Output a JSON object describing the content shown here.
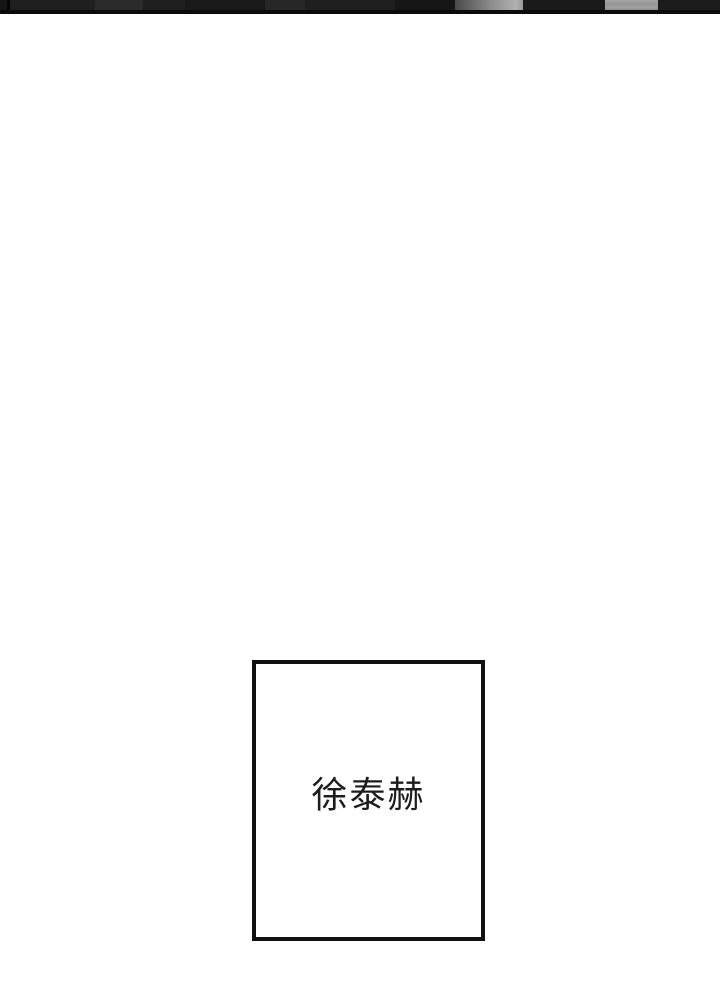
{
  "page": {
    "background_color": "#ffffff",
    "kind": "comic-page-segment"
  },
  "top_panel_edge": {
    "description": "bottom sliver of previous panel cut off by top of screenshot",
    "base_color": "#1f1f1f",
    "bottom_border_color": "#0b0b0b",
    "highlight_color": "#a0a0a0"
  },
  "name_card": {
    "label": "徐泰赫",
    "border_color": "#111111",
    "text_color": "#1c1c1c",
    "background_color": "#ffffff"
  }
}
